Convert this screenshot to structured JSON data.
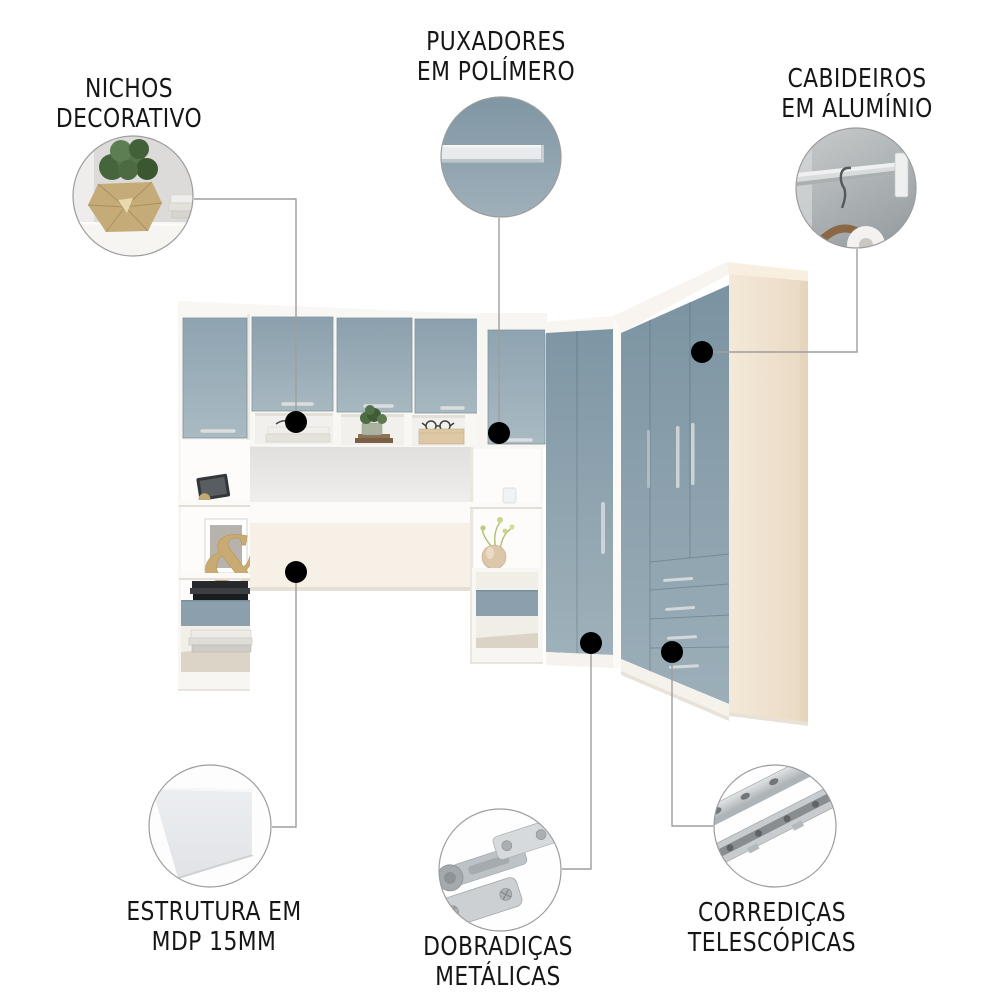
{
  "page": {
    "background": "#ffffff",
    "description_visible_text_language": "pt-BR"
  },
  "palette": {
    "door_blue": "#8ca2af",
    "door_blue_dark": "#7d95a3",
    "door_blue_light": "#a9bac3",
    "drawer_blue": "#8ba0ac",
    "carcass_white": "#f8f6f3",
    "cream_side": "#f0e5d3",
    "headboard_cream": "#f6f0e7",
    "text_color": "#161616",
    "connector_gray": "#9e9e9e",
    "dot_black": "#000000",
    "circle_border": "#9c9c9c",
    "gold_vase": "#c5ab77",
    "plant_green": "#4c6b42"
  },
  "callouts": [
    {
      "id": "nichos",
      "label_line1": "NICHOS",
      "label_line2": "DECORATIVO",
      "icon": "decorative-niche-photo-icon"
    },
    {
      "id": "puxadores",
      "label_line1": "PUXADORES",
      "label_line2": "EM POLÍMERO",
      "icon": "polymer-handle-photo-icon"
    },
    {
      "id": "cabideiros",
      "label_line1": "CABIDEIROS",
      "label_line2": "EM ALUMÍNIO",
      "icon": "aluminum-rail-photo-icon"
    },
    {
      "id": "estrutura",
      "label_line1": "ESTRUTURA EM",
      "label_line2": "MDP 15MM",
      "icon": "mdp-panel-photo-icon"
    },
    {
      "id": "dobradicas",
      "label_line1": "DOBRADIÇAS",
      "label_line2": "METÁLICAS",
      "icon": "metal-hinge-photo-icon"
    },
    {
      "id": "corredicas",
      "label_line1": "CORREDIÇAS",
      "label_line2": "TELESCÓPICAS",
      "icon": "telescopic-slides-photo-icon"
    }
  ],
  "decor": {
    "ampersand": "&"
  }
}
